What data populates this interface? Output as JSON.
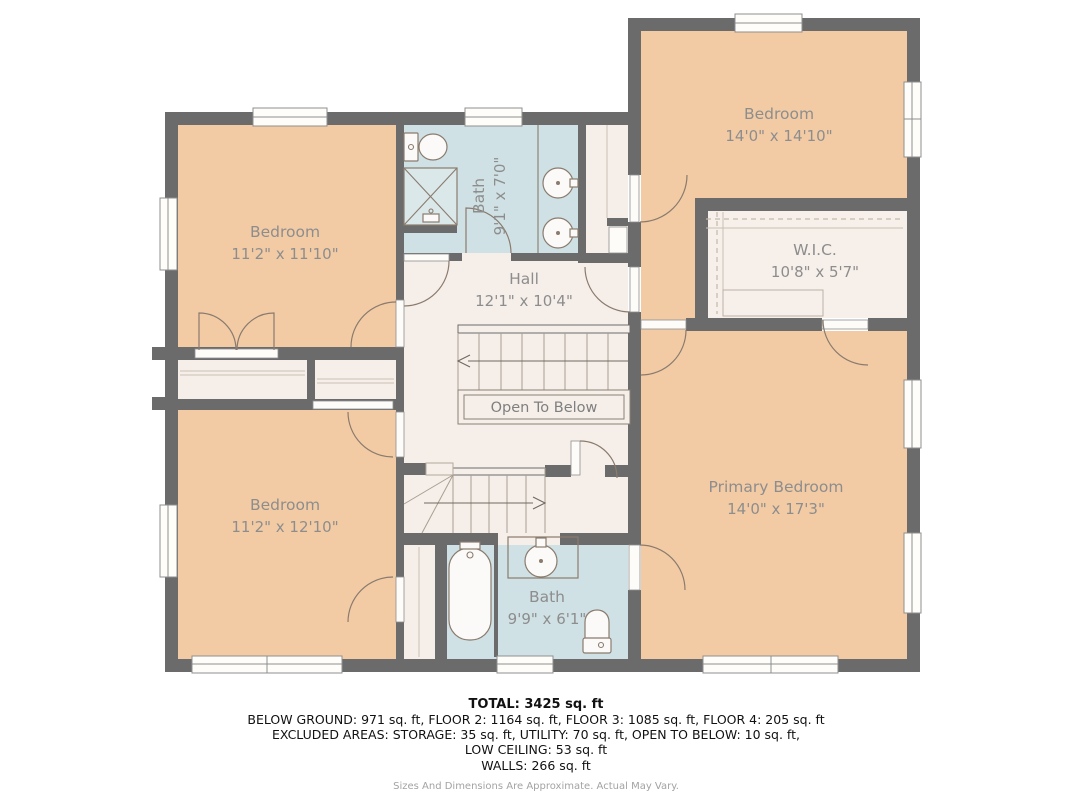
{
  "rooms": {
    "bedroom_top_left": {
      "name": "Bedroom",
      "dims": "11'2\" x 11'10\""
    },
    "bath_top": {
      "name": "Bath",
      "dims": "9'1\" x 7'0\""
    },
    "bedroom_top_right": {
      "name": "Bedroom",
      "dims": "14'0\" x 14'10\""
    },
    "wic": {
      "name": "W.I.C.",
      "dims": "10'8\" x 5'7\""
    },
    "hall": {
      "name": "Hall",
      "dims": "12'1\" x 10'4\""
    },
    "open_to_below": {
      "label": "Open To Below"
    },
    "bedroom_bottom_left": {
      "name": "Bedroom",
      "dims": "11'2\" x 12'10\""
    },
    "bath_bottom": {
      "name": "Bath",
      "dims": "9'9\" x 6'1\""
    },
    "primary_bedroom": {
      "name": "Primary Bedroom",
      "dims": "14'0\" x 17'3\""
    }
  },
  "footer": {
    "total": "TOTAL: 3425 sq. ft",
    "floors": "BELOW GROUND: 971 sq. ft, FLOOR 2: 1164 sq. ft, FLOOR 3: 1085 sq. ft, FLOOR 4: 205 sq. ft",
    "excluded": "EXCLUDED AREAS: STORAGE: 35 sq. ft, UTILITY: 70 sq. ft, OPEN TO BELOW: 10 sq. ft,",
    "low_ceiling": "LOW CEILING: 53 sq. ft",
    "walls": "WALLS: 266 sq. ft",
    "disclaimer": "Sizes And Dimensions Are Approximate. Actual May Vary."
  },
  "colors": {
    "bedroom_fill": "#f2cba5",
    "bath_fill": "#cfe1e4",
    "hall_fill": "#f6efe9",
    "wall": "#6b6b6b",
    "label_text": "#8d8d8d"
  }
}
